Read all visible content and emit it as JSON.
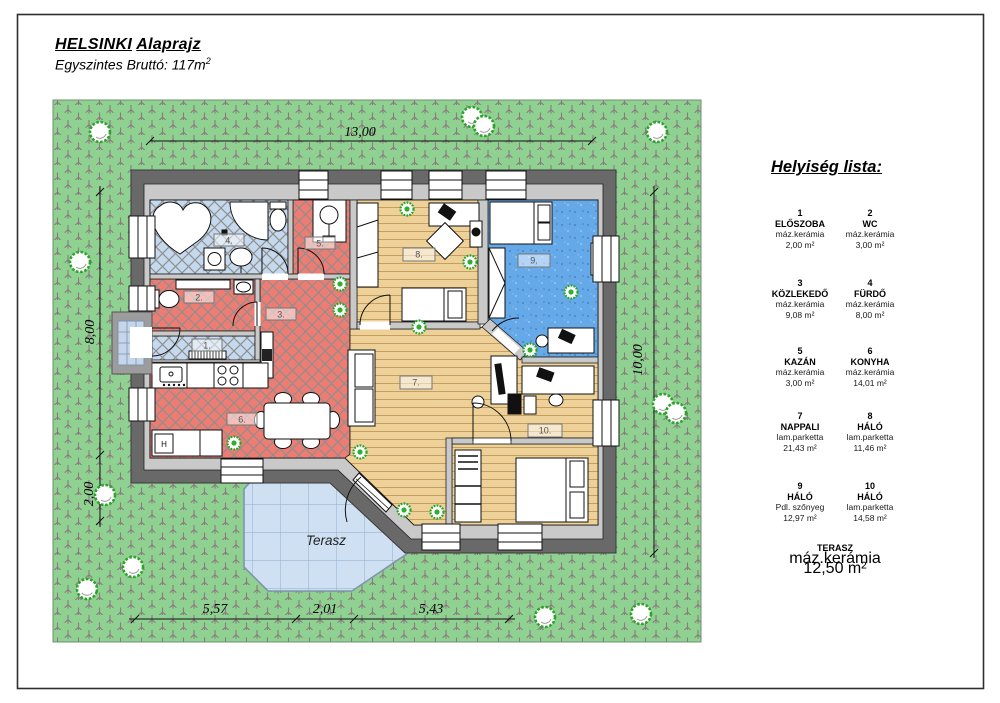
{
  "page": {
    "title_word1": "HELSINKI",
    "title_word2": "Alaprajz",
    "subtitle": "Egyszintes Bruttó: 117m",
    "subtitle_sup": "2"
  },
  "legend": {
    "title": "Helyiség lista:",
    "rooms": [
      {
        "num": "1",
        "name": "ELŐSZOBA",
        "material": "máz.kerámia",
        "area": "2,00 m²"
      },
      {
        "num": "2",
        "name": "WC",
        "material": "máz.kerámia",
        "area": "3,00 m²"
      },
      {
        "num": "3",
        "name": "KÖZLEKEDŐ",
        "material": "máz.kerámia",
        "area": "9,08 m²"
      },
      {
        "num": "4",
        "name": "FÜRDŐ",
        "material": "máz.kerámia",
        "area": "8,00 m²"
      },
      {
        "num": "5",
        "name": "KAZÁN",
        "material": "máz.kerámia",
        "area": "3,00 m²"
      },
      {
        "num": "6",
        "name": "KONYHA",
        "material": "máz.kerámia",
        "area": "14,01 m²"
      },
      {
        "num": "7",
        "name": "NAPPALI",
        "material": "lam.parketta",
        "area": "21,43 m²"
      },
      {
        "num": "8",
        "name": "HÁLÓ",
        "material": "lam.parketta",
        "area": "11,46 m²"
      },
      {
        "num": "9",
        "name": "HÁLÓ",
        "material": "Pdl. szőnyeg",
        "area": "12,97 m²"
      },
      {
        "num": "10",
        "name": "HÁLÓ",
        "material": "lam.parketta",
        "area": "14,58 m²"
      }
    ],
    "terrace": {
      "name": "TERASZ",
      "material": "máz.kerámia",
      "area": "12,50 m²"
    }
  },
  "dimensions": {
    "top": "13,00",
    "left_upper": "8,00",
    "left_lower": "2,00",
    "right": "10,00",
    "bottom_left": "5,57",
    "bottom_middle": "2,01",
    "bottom_right": "5,43"
  },
  "plan": {
    "terrace_label": "Terasz",
    "fridge_label": "H",
    "room_labels": [
      "1.",
      "2.",
      "3.",
      "4.",
      "5.",
      "6.",
      "7.",
      "8.",
      "9.",
      "10."
    ]
  },
  "colors": {
    "lawn": "#8fd191",
    "tile_red": "#ef7c72",
    "tile_blue": "#c4d8ee",
    "wood": "#edd198",
    "carpet": "#66a9e9",
    "terrace": "#cfe0f3",
    "wall": "#696969"
  }
}
